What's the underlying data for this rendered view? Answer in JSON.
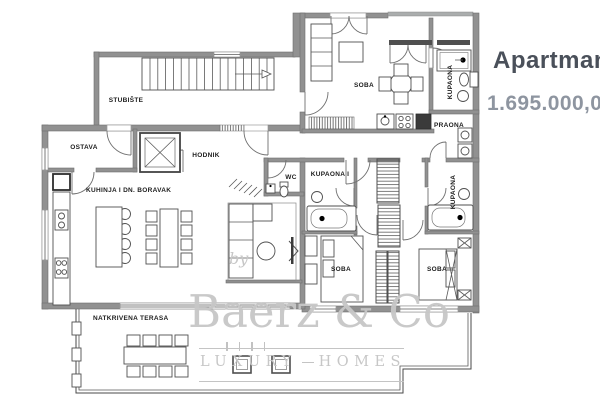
{
  "listing": {
    "title": "Apartman",
    "price": "1.695.000,00"
  },
  "watermark": {
    "by": "by",
    "brand": "Baerz & Co",
    "tagline_left": "LUXURY",
    "tagline_right": "HOMES"
  },
  "floor_plan": {
    "rooms": [
      {
        "id": "stubiste",
        "label": "STUBIŠTE"
      },
      {
        "id": "ostava",
        "label": "OSTAVA"
      },
      {
        "id": "hodnik",
        "label": "HODNIK"
      },
      {
        "id": "kuhinja-dn-boravak",
        "label": "KUHINJA I DN. BORAVAK"
      },
      {
        "id": "wc",
        "label": "WC"
      },
      {
        "id": "soba-studio",
        "label": "SOBA"
      },
      {
        "id": "kupaona-gornja",
        "label": "KUPAONA"
      },
      {
        "id": "praona",
        "label": "PRAONA"
      },
      {
        "id": "kupaona-1",
        "label": "KUPAONA I"
      },
      {
        "id": "kupaona-srednja",
        "label": "KUPAONA"
      },
      {
        "id": "soba-lijeva",
        "label": "SOBA"
      },
      {
        "id": "soba-desna",
        "label": "SOBA"
      },
      {
        "id": "natkrivena-terasa",
        "label": "NATKRIVENA TERASA"
      }
    ]
  },
  "colors": {
    "title_text": "#4a505a",
    "price_text": "#8e95a0",
    "wall_fill": "#919191",
    "line_dark": "#4a4a4a",
    "label_text": "#1d1d1d",
    "watermark_gray": "#c7c7c7"
  }
}
